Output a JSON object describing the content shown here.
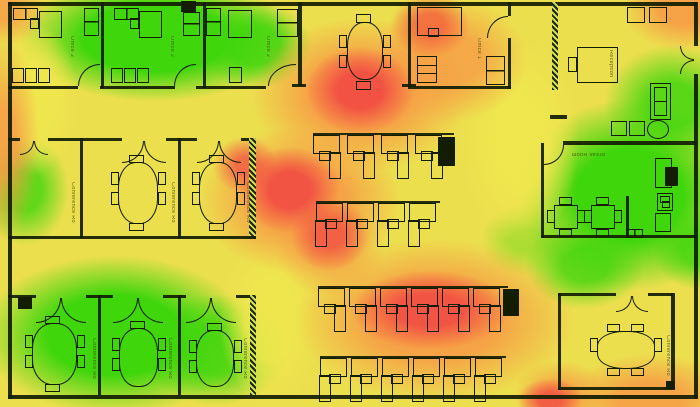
{
  "heatmap": {
    "type": "wifi-signal-coverage-floorplan",
    "palette": {
      "strong": "#3fd60c",
      "good": "#a8dd1e",
      "fair": "#efe74e",
      "weak": "#f79b45",
      "poor": "#f25043"
    }
  },
  "rooms": [
    {
      "id": "office-top-left-1",
      "label": "Office 2"
    },
    {
      "id": "office-top-left-2",
      "label": "Office 2"
    },
    {
      "id": "office-top-left-3",
      "label": "Office 2"
    },
    {
      "id": "office-1",
      "label": "Office 1"
    },
    {
      "id": "reception",
      "label": "Reception"
    },
    {
      "id": "break-room",
      "label": "Break Room"
    },
    {
      "id": "conference-mid-1",
      "label": "Conference Ro"
    },
    {
      "id": "conference-mid-2",
      "label": "Conference Ro"
    },
    {
      "id": "conference-mid-3",
      "label": "Conference Ro"
    },
    {
      "id": "conference-bottom-1",
      "label": "Conference Ro"
    },
    {
      "id": "conference-bottom-2",
      "label": "Conference Ro"
    },
    {
      "id": "conference-bottom-3",
      "label": "Conference Ro"
    },
    {
      "id": "conference-right",
      "label": "Conference Ro"
    }
  ],
  "icons": {
    "access_point": "filled-black-square",
    "printer": "filled-black-rectangle",
    "refrigerator": "filled-black-rectangle"
  }
}
